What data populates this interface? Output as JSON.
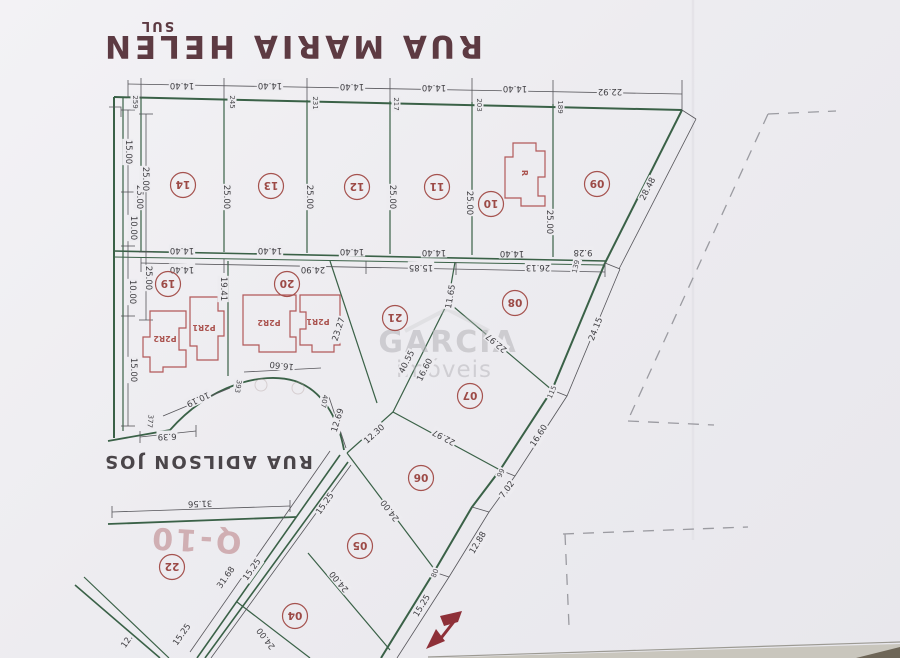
{
  "photo": {
    "watermark": {
      "line1": "GARCIA",
      "line2": "imóveis"
    }
  },
  "map": {
    "direction_label": "SUL",
    "street_top": "RUA MARIA HELEN",
    "street_left": "RUA ADILSON JOS",
    "block_label": "Q-10"
  },
  "lots": {
    "l04": "04",
    "l05": "05",
    "l06": "06",
    "l07": "07",
    "l08": "08",
    "l09": "09",
    "l10": "10",
    "l11": "11",
    "l12": "12",
    "l13": "13",
    "l14": "14",
    "l19": "19",
    "l20": "20",
    "l21": "21",
    "l22": "22"
  },
  "houses": [
    "P2R2",
    "P2R1",
    "P2R2",
    "P2R1",
    "R"
  ],
  "dims": [
    "14.40",
    "14.40",
    "14.40",
    "14.40",
    "14.40",
    "22.92",
    "28.48",
    "25.00",
    "25.00",
    "25.00",
    "25.00",
    "25.00",
    "25.00",
    "14.40",
    "14.40",
    "14.40",
    "14.40",
    "14.40",
    "9.28",
    "14.40",
    "24.90",
    "15.85",
    "26.13",
    "15.00",
    "25.00",
    "10.00",
    "25.00",
    "10.00",
    "15.00",
    "19.41",
    "23.27",
    "11.65",
    "40.55",
    "16.60",
    "22.97",
    "24.15",
    "16.60",
    "22.97",
    "12.30",
    "7.02",
    "12.88",
    "15.25",
    "24.00",
    "24.00",
    "24.00",
    "15.25",
    "31.68",
    "15.25",
    "15.25",
    "12.",
    "16.60",
    "10.19",
    "12.69",
    "31.56",
    "6.39"
  ],
  "stations": [
    "259",
    "245",
    "231",
    "217",
    "203",
    "189",
    "139",
    "115",
    "99",
    "80",
    "393",
    "407",
    "377"
  ]
}
